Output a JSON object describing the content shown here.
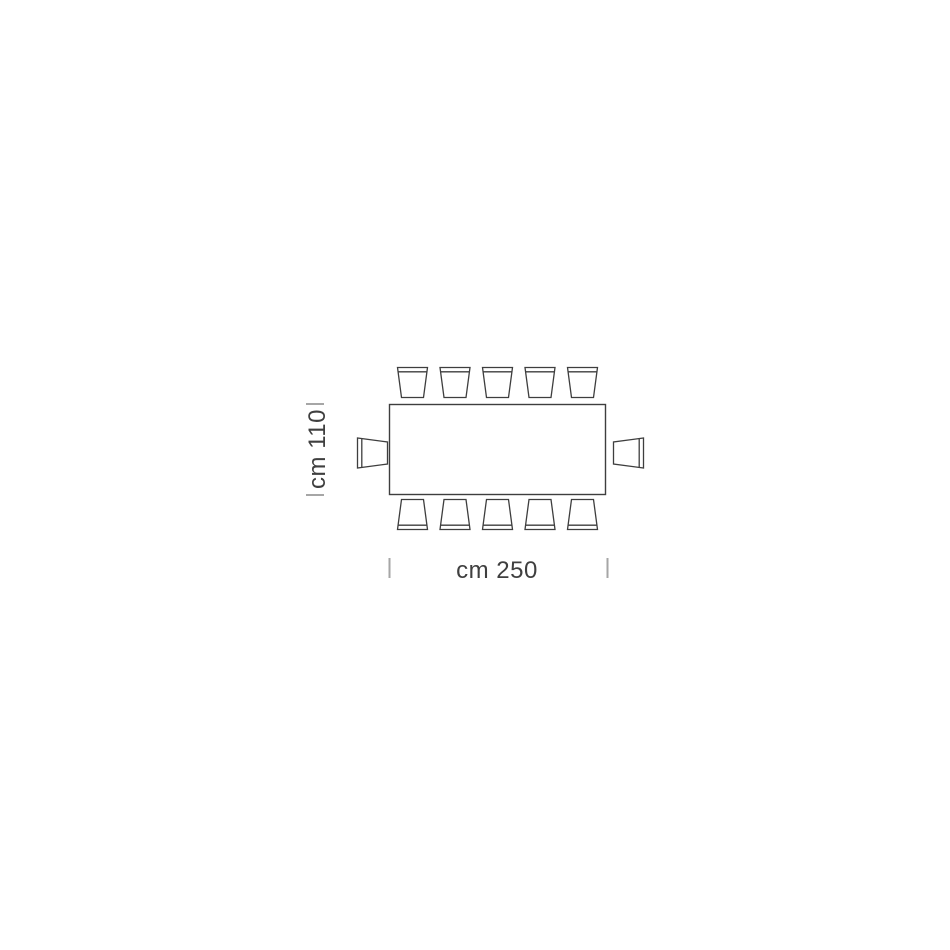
{
  "page": {
    "background_color": "#ffffff"
  },
  "diagram": {
    "kind": "furniture-top-view-dimension-drawing",
    "subject": "rectangular-dining-table-with-chairs",
    "table": {
      "shape": "rectangle",
      "width_label": "cm 250",
      "depth_label": "cm 110"
    },
    "chairs": {
      "top_row_count": 5,
      "bottom_row_count": 5,
      "left_end_count": 1,
      "right_end_count": 1,
      "total": 12
    },
    "colors": {
      "line": "#3e3e3e",
      "tick": "#a6a6a6",
      "label_text": "#3f3f3f",
      "fill": "#ffffff"
    }
  }
}
